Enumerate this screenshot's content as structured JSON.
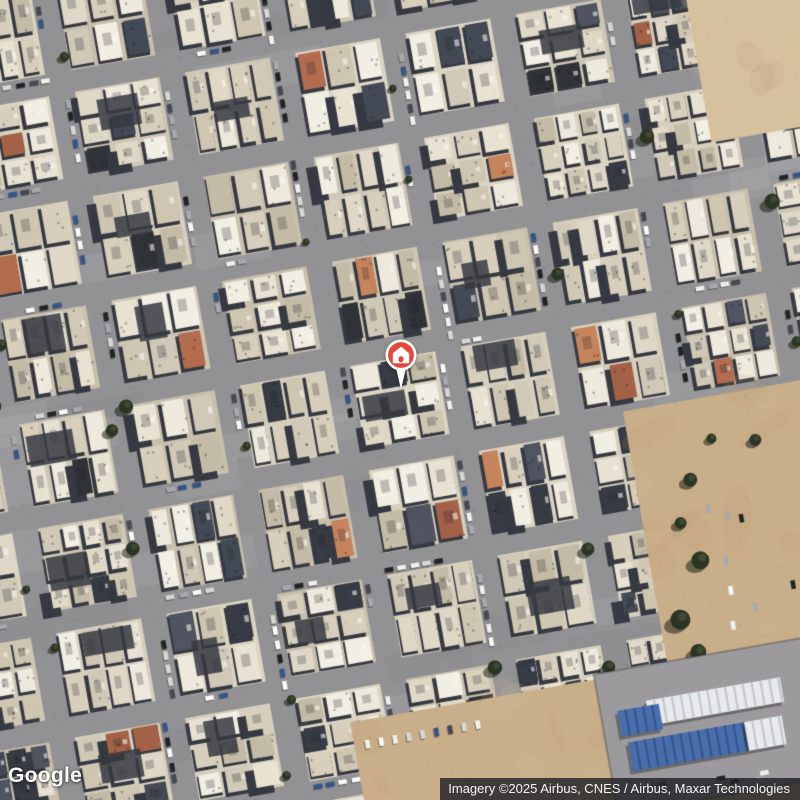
{
  "map": {
    "provider_logo": "Google",
    "attribution": "Imagery ©2025 Airbus, CNES / Airbus, Maxar Technologies",
    "view": {
      "type": "satellite",
      "rotation_deg": -10
    },
    "marker": {
      "kind": "home-place-marker",
      "color": "#E5483B",
      "ring": "#FFFFFF",
      "icon": "home"
    },
    "palette": {
      "street": "#8d8d93",
      "street_shade": "#6e707a",
      "block_bases": [
        "#cfc8b7",
        "#d7d0c0",
        "#c7bfae",
        "#ddd6c6"
      ],
      "roofs": [
        "#eae5d8",
        "#e1dacb",
        "#d8d0bf",
        "#f0ece2",
        "#cec6b3",
        "#c3bba8",
        "#f4f1e9",
        "#d0cabb"
      ],
      "dark": [
        "#2c313d",
        "#3a4150",
        "#232730",
        "#454c5c"
      ],
      "shadow": "#2a2f3b",
      "red_roofs": [
        "#b2664a",
        "#c47f58",
        "#a05a41"
      ],
      "sand": "#c9ad89",
      "sand_light": "#d6c19f",
      "sand_dark": "#b3946f",
      "pavement": "#98979c",
      "tree": "#202a1a",
      "tree_light": "#33412a",
      "tent_blue": "#3e68ad",
      "tent_blue_dark": "#294e8e",
      "tent_white": "#eaedf1",
      "tent_white_dark": "#c2c9d3",
      "cars": [
        "#f4f4f4",
        "#ffffff",
        "#14171d",
        "#3c414b",
        "#a3a8af",
        "#d9d9d9",
        "#2b4d86"
      ]
    }
  }
}
